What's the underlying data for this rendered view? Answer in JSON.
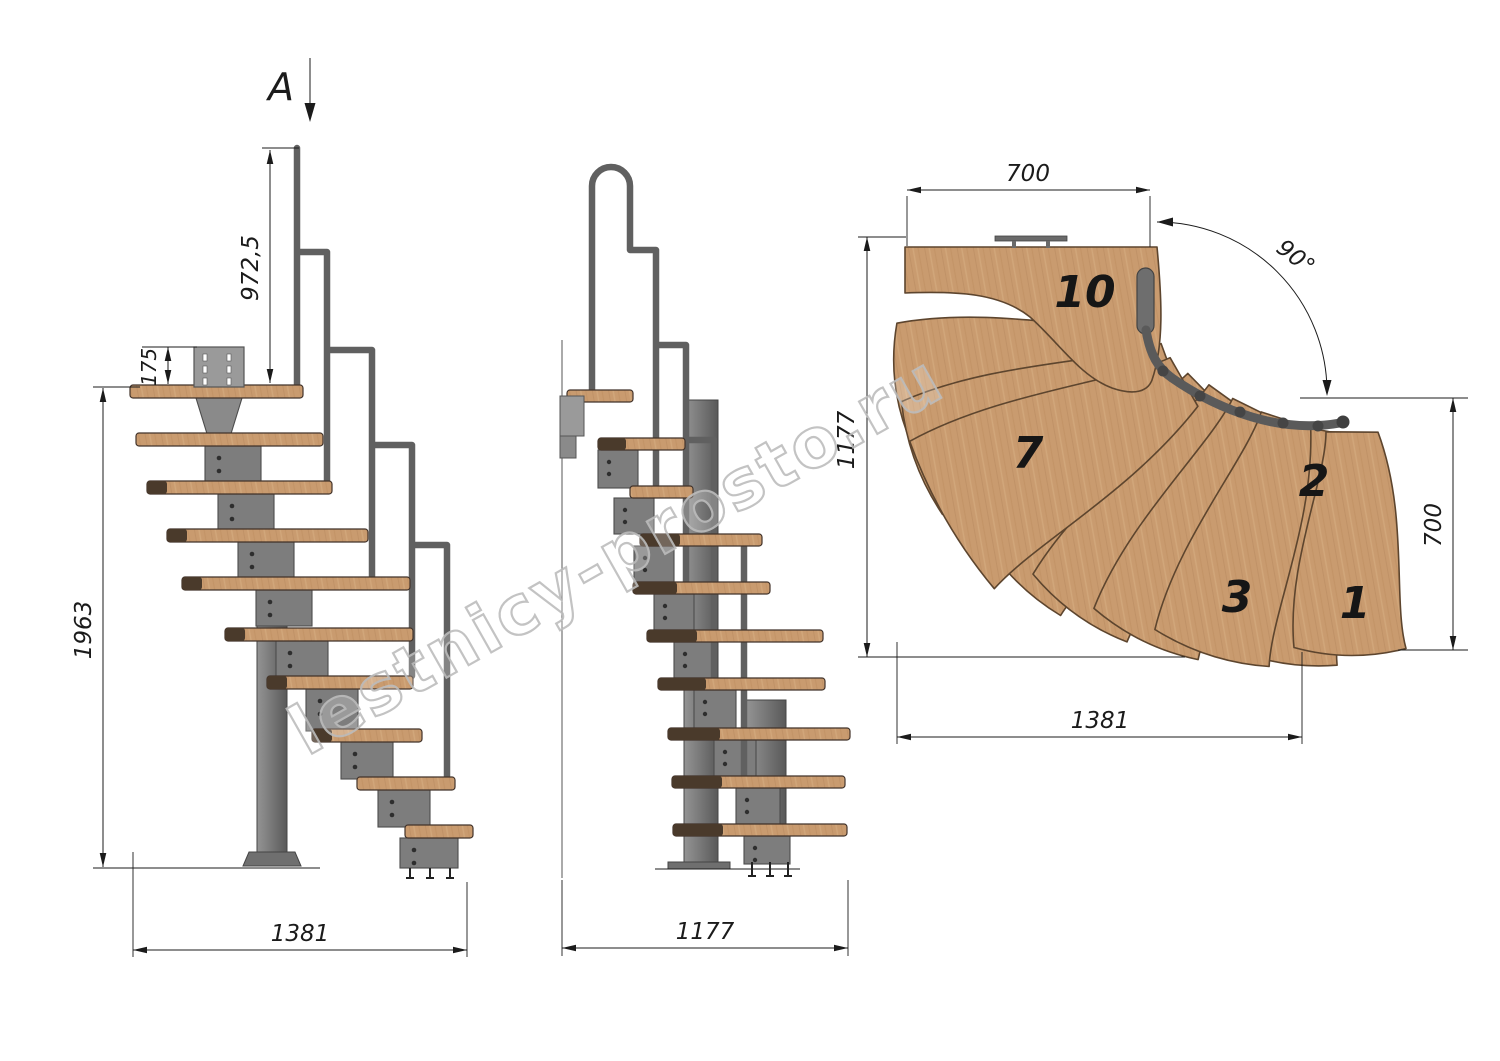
{
  "section_view": {
    "label": "A"
  },
  "watermark": {
    "text": "lestnicy-prosto.ru"
  },
  "side_view_a": {
    "dim_handrail_height": "972,5",
    "dim_mount_plate": "175",
    "dim_total_height": "1963",
    "dim_total_length": "1381"
  },
  "front_view": {
    "dim_total_width": "1177"
  },
  "plan_view": {
    "dim_landing_width": "700",
    "dim_side_depth": "1177",
    "dim_turn_angle": "90°",
    "dim_exit_depth": "700",
    "dim_total_length": "1381",
    "step_labels": {
      "step_10": "10",
      "step_7": "7",
      "step_3": "3",
      "step_2": "2",
      "step_1": "1"
    }
  },
  "colors": {
    "wood": "#c99b6f",
    "wood_dark": "#4a3a2b",
    "metal": "#7d7d7d",
    "metal_dark": "#4c4c4c",
    "line": "#1b1b1b",
    "watermark": "#bdbdbd"
  }
}
